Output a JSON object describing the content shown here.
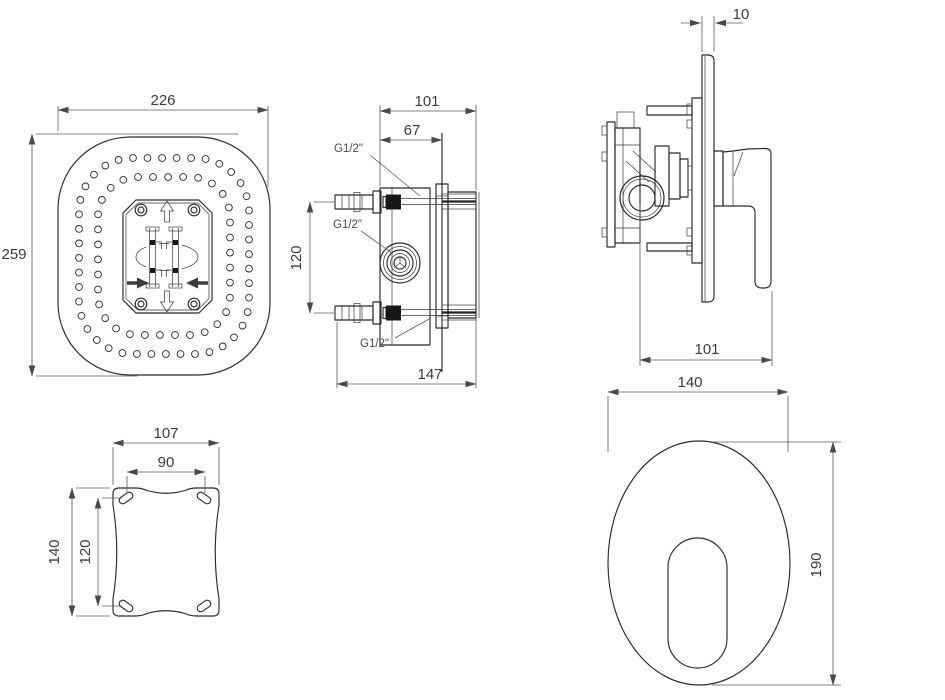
{
  "drawing": {
    "background": "#ffffff",
    "line_color": "#2b2b2b",
    "dim_color": "#5c5c5c",
    "views": {
      "shower_head_plan": {
        "width": "226",
        "height": "259"
      },
      "valve_rough_in_section": {
        "depth_overall": "101",
        "depth_to_wall": "67",
        "inlet_spacing": "120",
        "total_depth": "147",
        "port_top": "G1/2\"",
        "port_center": "G1/2\"",
        "port_bottom": "G1/2\""
      },
      "mixer_side": {
        "plate_thickness": "10",
        "handle_reach": "101"
      },
      "mounting_plate": {
        "outer_width": "107",
        "slot_spacing_width": "90",
        "outer_height": "140",
        "slot_spacing_height": "120"
      },
      "trim_plate_front": {
        "width": "140",
        "height": "190"
      }
    },
    "nozzle_rings": [
      {
        "x": 79,
        "y": 158,
        "w": 170,
        "h": 196,
        "r": 54,
        "count": 44,
        "hole_r": 3.4
      },
      {
        "x": 98,
        "y": 177,
        "w": 132,
        "h": 158,
        "r": 40,
        "count": 34,
        "hole_r": 3.4
      }
    ]
  }
}
